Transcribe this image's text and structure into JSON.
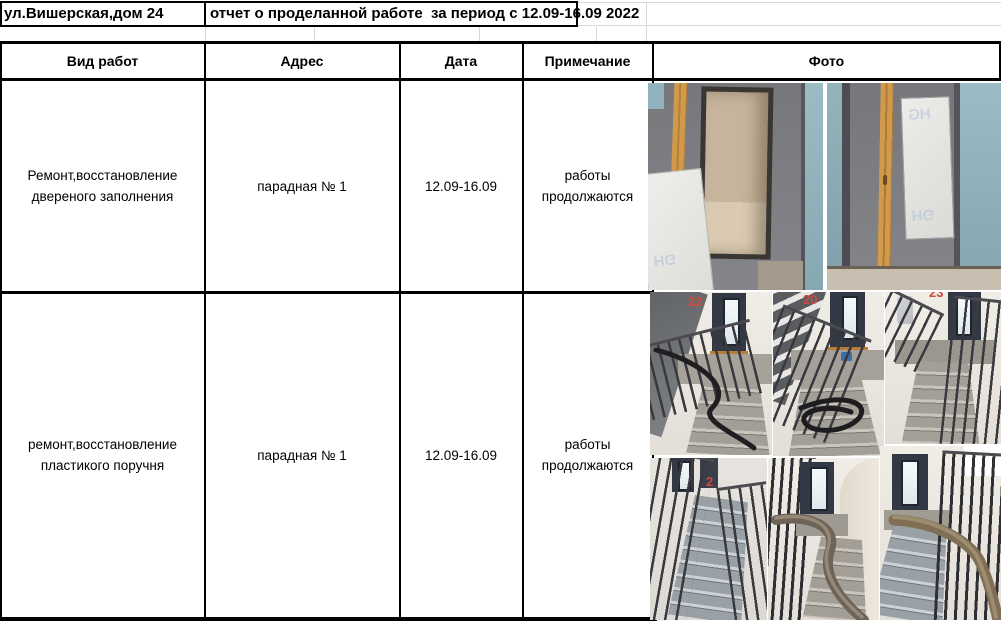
{
  "title": {
    "address": "ул.Вишерская,дом 24",
    "report": "отчет о проделанной работе  за период с 12.09-16.09 2022"
  },
  "header": {
    "work": "Вид работ",
    "address": "Адрес",
    "date": "Дата",
    "note": "Примечание",
    "photo": "Фото"
  },
  "rows": [
    {
      "work_line1": "Ремонт,восстановление",
      "work_line2": "двереного заполнения",
      "address": "парадная № 1",
      "date": "12.09-16.09",
      "note_line1": "работы",
      "note_line2": "продолжаются"
    },
    {
      "work_line1": "ремонт,восстановление",
      "work_line2": "пластикого поручня",
      "address": "парадная № 1",
      "date": "12.09-16.09",
      "note_line1": "работы",
      "note_line2": "продолжаются"
    }
  ],
  "photos": {
    "foam_marking": "HG",
    "stair_numbers": {
      "n1": "22",
      "n2": "20",
      "n3": "23",
      "n4": "2"
    }
  },
  "colors": {
    "border": "#000000",
    "stair_number_red": "#cf4a3e",
    "teal_wall": "#8fb2bc",
    "grey_door": "#7b7c80",
    "wood_plank": "#cf9a4e"
  }
}
